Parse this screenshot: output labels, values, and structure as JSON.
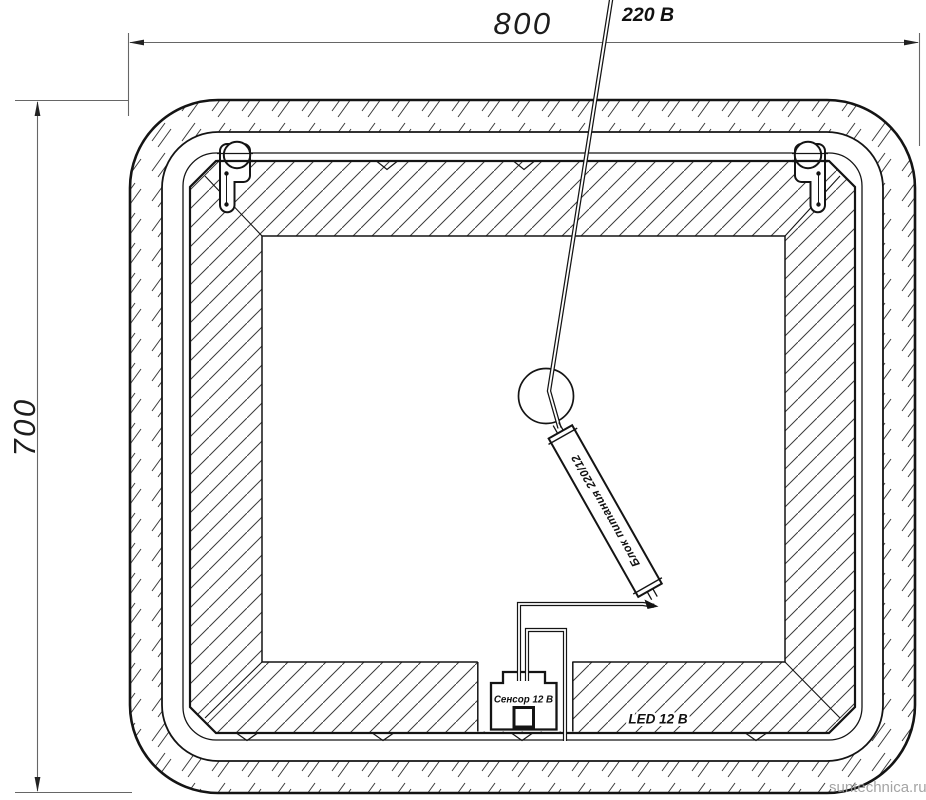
{
  "drawing": {
    "width_label": "800",
    "height_label": "700",
    "power_line_label": "220 В",
    "power_supply_label": "Блок питания 220/12",
    "sensor_label": "Сенсор 12 В",
    "led_label": "LED 12 В",
    "watermark": "suntechnica.ru",
    "colors": {
      "line": "#141414",
      "dimension_line": "#666666",
      "hatch": "#3a3a3a",
      "watermark": "#9b9b9b",
      "background": "#ffffff"
    }
  }
}
